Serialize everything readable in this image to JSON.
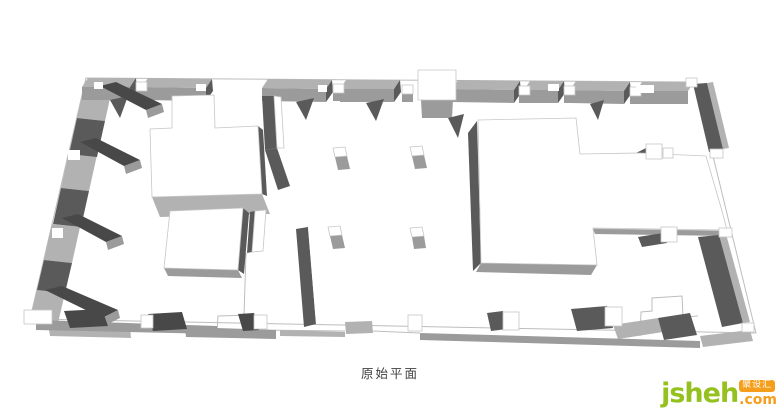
{
  "caption": {
    "text": "原始平面"
  },
  "watermark": {
    "brand": "jsheh",
    "suffix": ".com",
    "badge": "聚设汇"
  },
  "colors": {
    "background": "#ffffff",
    "wall_top": "#b2b2b2",
    "wall_front": "#9b9b9b",
    "wall_side_dark": "#5a5a5a",
    "wall_shadow": "#484848",
    "block_face": "#ffffff",
    "edge_line": "#bdbdbd",
    "caption_color": "#3f3f3f",
    "brand_green": "#95c11f",
    "brand_orange": "#f59e1c"
  }
}
